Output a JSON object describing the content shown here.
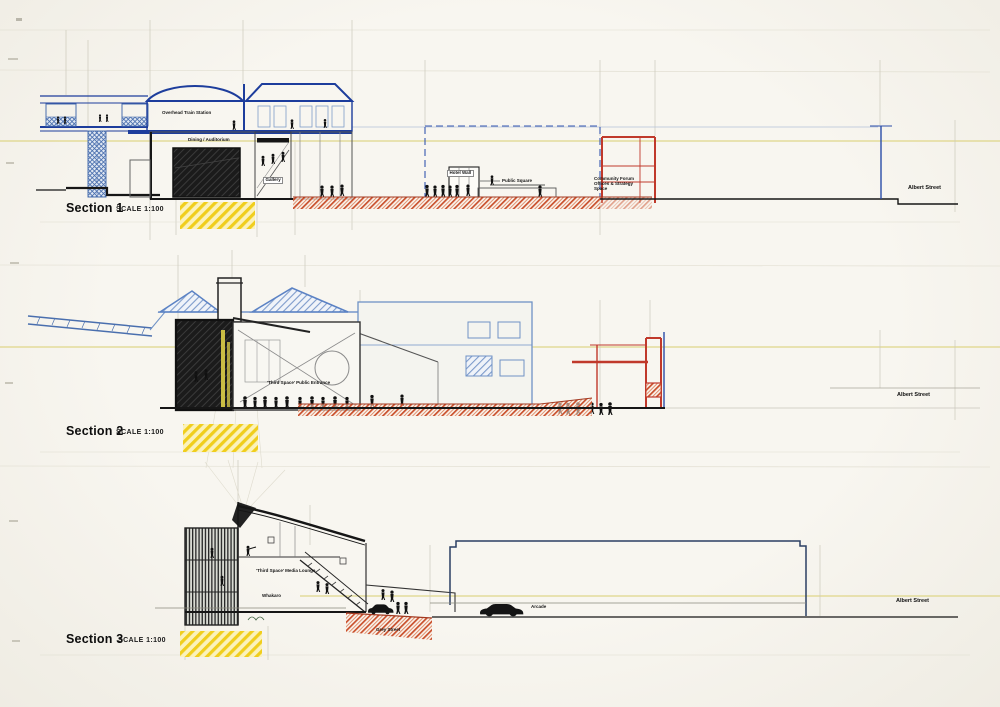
{
  "sections": [
    {
      "title": "Section 1",
      "scale": "SCALE 1:100",
      "labels": {
        "station": "Overhead Train Station",
        "dining": "Dining / Auditorium",
        "gallery": "Gallery",
        "hotel_wall": "Hotel Wall",
        "public_square": "Public Square",
        "community": "Community Forum Offices & Strategy Space",
        "street": "Albert Street"
      }
    },
    {
      "title": "Section 2",
      "scale": "SCALE 1:100",
      "labels": {
        "entrance": "'Third Space' Public Entrance",
        "street": "Albert Street"
      }
    },
    {
      "title": "Section 3",
      "scale": "SCALE 1:100",
      "labels": {
        "lounge": "'Third Space' Media Lounge",
        "whakaro": "Whakaro",
        "grey_street": "Grey Street",
        "arcade": "Arcade",
        "street": "Albert Street"
      }
    }
  ],
  "colors": {
    "ink_blue": "#1d3d9c",
    "pencil_blue": "#7e9cc9",
    "section_cut_red": "#c8502c",
    "highlight_yellow": "#f0ce1d",
    "ink_black": "#161616"
  }
}
